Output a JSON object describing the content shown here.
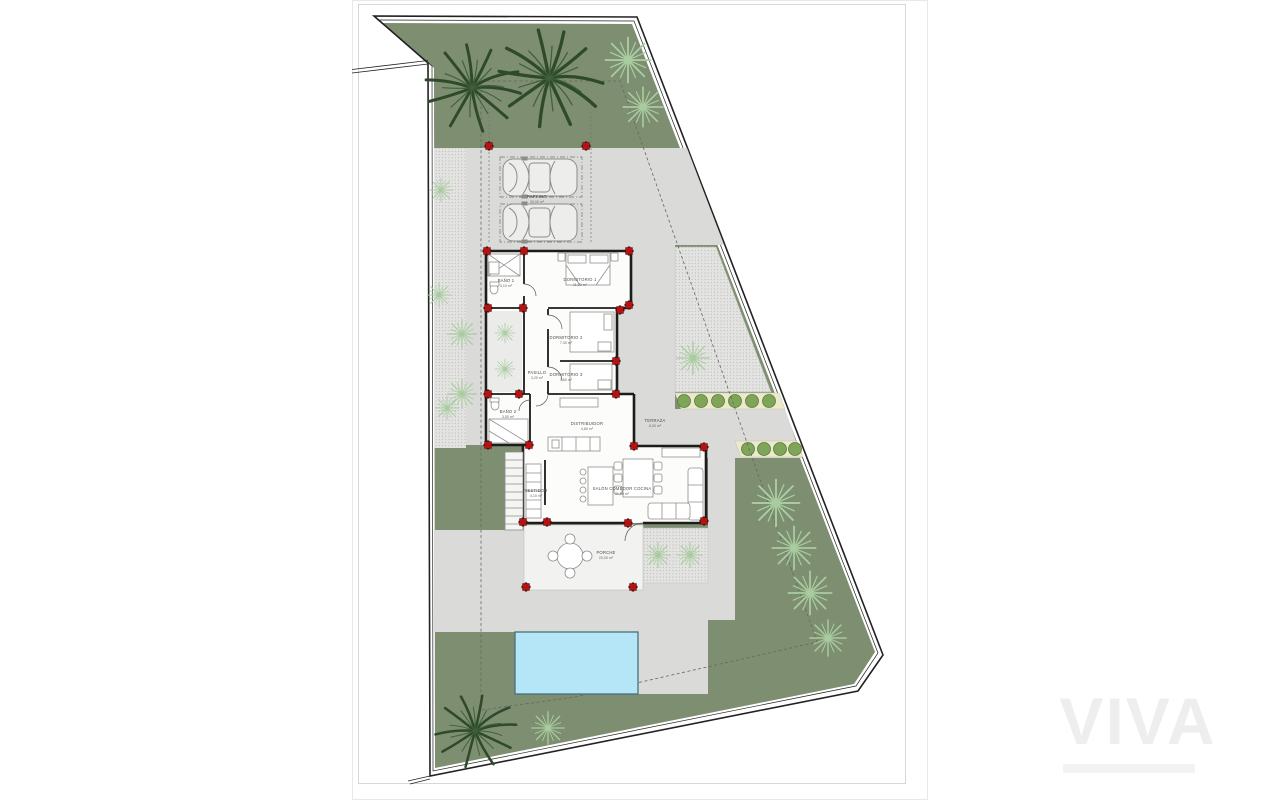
{
  "watermark": {
    "text": "VIVA"
  },
  "plan": {
    "labels": {
      "parking": {
        "name": "PARKING",
        "area": "30,00 m²"
      },
      "bano1": {
        "name": "BAÑO 1",
        "area": "3,10 m²"
      },
      "dorm1": {
        "name": "DORMITORIO 1",
        "area": "11,20 m²"
      },
      "dorm2": {
        "name": "DORMITORIO 2",
        "area": "7,30 m²"
      },
      "dorm3": {
        "name": "DORMITORIO 3",
        "area": "7,60 m²"
      },
      "pasillo": {
        "name": "PASILLO",
        "area": "3,20 m²"
      },
      "bano2": {
        "name": "BAÑO 2",
        "area": "3,50 m²"
      },
      "distribuidor": {
        "name": "DISTRIBUIDOR",
        "area": "4,80 m²"
      },
      "terraza": {
        "name": "TERRAZA",
        "area": "8,00 m²"
      },
      "vestidor": {
        "name": "VESTIDOR",
        "area": "4,15 m²"
      },
      "salon": {
        "name": "SALÓN COMEDOR COCINA",
        "area": "31,50 m²"
      },
      "porche": {
        "name": "PORCHE",
        "area": "20,00 m²"
      }
    },
    "colors": {
      "garden_green": "#7D8E71",
      "paving_gray": "#DADAD8",
      "hatch_gray": "#E3E3E1",
      "pool_blue": "#B5E6F8",
      "pool_border": "#48707C",
      "planter_cream": "#EDE9CC",
      "bush_green": "#7FA558",
      "column_red": "#B71212",
      "dark_palm": "#2E4A2B",
      "light_plant": "#A9CCA0",
      "wall_black": "#1C1C1C",
      "boundary_black": "#222222"
    }
  }
}
